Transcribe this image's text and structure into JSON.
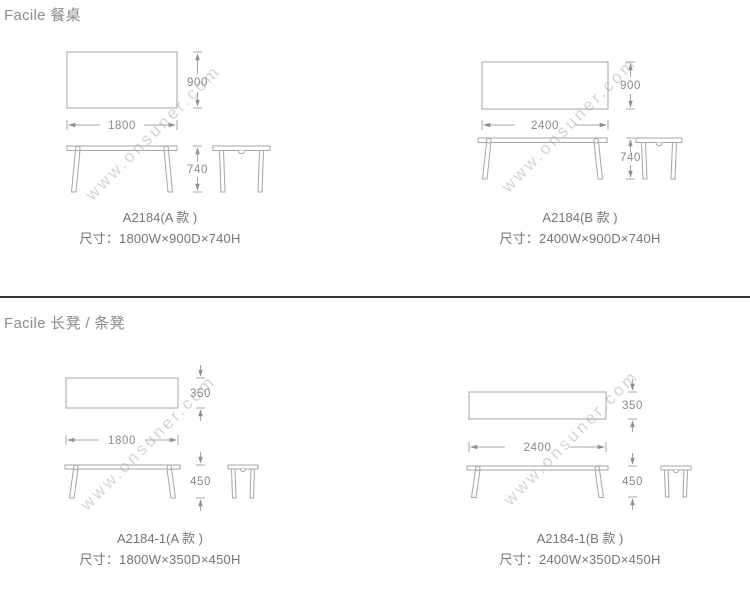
{
  "sections": [
    {
      "header": "Facile 餐桌"
    },
    {
      "header": "Facile 长凳 / 条凳"
    }
  ],
  "watermark": {
    "text": "www.onsuner.com"
  },
  "products": {
    "table_a": {
      "model": "A2184(A 款 )",
      "size": "尺寸：1800W×900D×740H",
      "width": "1800",
      "depth": "900",
      "height": "740"
    },
    "table_b": {
      "model": "A2184(B 款 )",
      "size": "尺寸：2400W×900D×740H",
      "width": "2400",
      "depth": "900",
      "height": "740"
    },
    "bench_a": {
      "model": "A2184-1(A 款 )",
      "size": "尺寸：1800W×350D×450H",
      "width": "1800",
      "depth": "350",
      "height": "450"
    },
    "bench_b": {
      "model": "A2184-1(B 款 )",
      "size": "尺寸：2400W×350D×450H",
      "width": "2400",
      "depth": "350",
      "height": "450"
    }
  },
  "colors": {
    "line": "#a6a6a6",
    "arrow": "#8f8f8f",
    "dim_text": "#8a8a8a",
    "header_text": "#8c8c8c",
    "label_text": "#757575",
    "divider": "#343434",
    "watermark": "#c9c9c9",
    "background": "#ffffff"
  }
}
